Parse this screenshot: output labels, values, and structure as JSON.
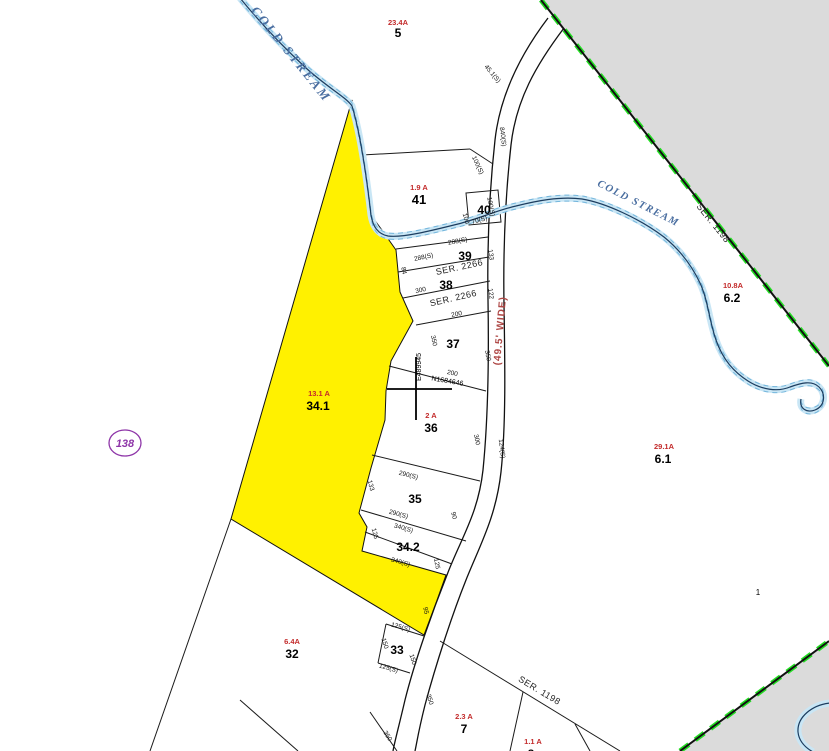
{
  "map_sheet": {
    "number": "138"
  },
  "parcels": [
    {
      "id": "5",
      "acreage": "23.4A"
    },
    {
      "id": "41",
      "acreage": "1.9 A"
    },
    {
      "id": "40",
      "acreage": ""
    },
    {
      "id": "39",
      "acreage": ""
    },
    {
      "id": "38",
      "acreage": ""
    },
    {
      "id": "37",
      "acreage": ""
    },
    {
      "id": "36",
      "acreage": "2 A"
    },
    {
      "id": "35",
      "acreage": ""
    },
    {
      "id": "34.1",
      "acreage": "13.1 A"
    },
    {
      "id": "34.2",
      "acreage": ""
    },
    {
      "id": "33",
      "acreage": ""
    },
    {
      "id": "32",
      "acreage": "6.4A"
    },
    {
      "id": "7",
      "acreage": "2.3 A"
    },
    {
      "id": "8",
      "acreage": "1.1 A"
    },
    {
      "id": "6.1",
      "acreage": "29.1A"
    },
    {
      "id": "6.2",
      "acreage": "10.8A"
    },
    {
      "id": "1",
      "acreage": ""
    }
  ],
  "streams": [
    {
      "name": "COLD STREAM"
    },
    {
      "name": "COLD STREAM"
    }
  ],
  "surveys": [
    {
      "ref": "SER. 2266"
    },
    {
      "ref": "SER. 2266"
    },
    {
      "ref": "SER. 1198"
    },
    {
      "ref": "SER. 1198"
    }
  ],
  "roads": {
    "width_label": "(49.5' WIDE)"
  },
  "grid": {
    "northing": "N1684646",
    "easting": "E489945"
  },
  "dimensions": [
    "45.1(S)",
    "840(S)",
    "100(S)",
    "100",
    "70(S)",
    "100(S)",
    "288(S)",
    "288(S)",
    "133",
    "84",
    "300",
    "122",
    "200",
    "350",
    "350",
    "200",
    "300",
    "124(S)",
    "290(S)",
    "133",
    "290(S)",
    "90",
    "340(S)",
    "125",
    "340(S)",
    "125",
    "95",
    "125(S)",
    "150",
    "150",
    "125(S)",
    "350",
    "350"
  ],
  "colors": {
    "highlight_parcel": "#FFF100",
    "adjacent_area_gray": "#DBDBDB",
    "boundary_green": "#23DD23",
    "acreage_red": "#C32B2B",
    "road_label_red": "#AE4745",
    "stream_text_blue": "#4A6EA0",
    "map_ref_purple": "#8E35A8"
  }
}
